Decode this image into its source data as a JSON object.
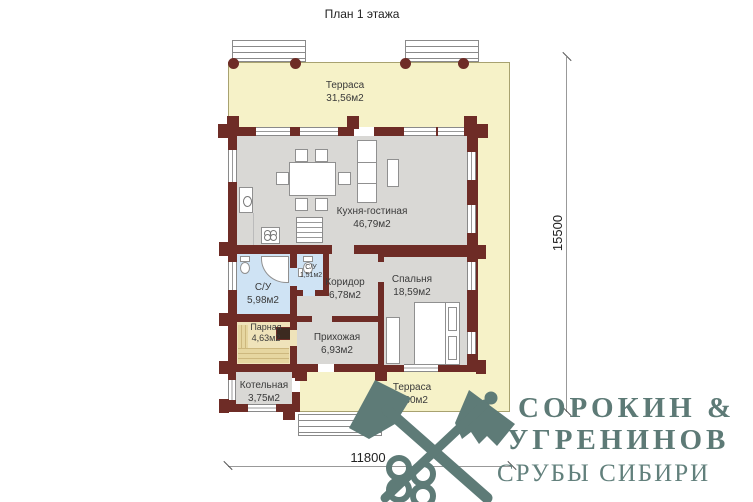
{
  "title": "План 1 этажа",
  "rooms": [
    {
      "label": "Терраса",
      "area": "31,56м2"
    },
    {
      "label": "Кухня-гостиная",
      "area": "46,79м2"
    },
    {
      "label": "С/У",
      "area": "5,98м2"
    },
    {
      "label": "С/У",
      "area": "1,51м2"
    },
    {
      "label": "Коридор",
      "area": "6,78м2"
    },
    {
      "label": "Спальня",
      "area": "18,59м2"
    },
    {
      "label": "Парная",
      "area": "4,63м2"
    },
    {
      "label": "Прихожая",
      "area": "6,93м2"
    },
    {
      "label": "Котельная",
      "area": "3,75м2"
    },
    {
      "label": "Терраса",
      "area": "6,30м2"
    }
  ],
  "dimensions": {
    "vertical": "15500",
    "horizontal": "11800"
  },
  "logo": {
    "line1": "СОРОКИН &",
    "line2": "УГРЕНИНОВ",
    "line3": "СРУБЫ СИБИРИ",
    "icon": "crossed-axes"
  },
  "colors": {
    "wall": "#6e2c26",
    "terrace": "#f6f2c8",
    "room": "#d9d8d5",
    "bath": "#cfe3f4",
    "sauna": "#efe3ba",
    "logo": "#5e7b77"
  }
}
